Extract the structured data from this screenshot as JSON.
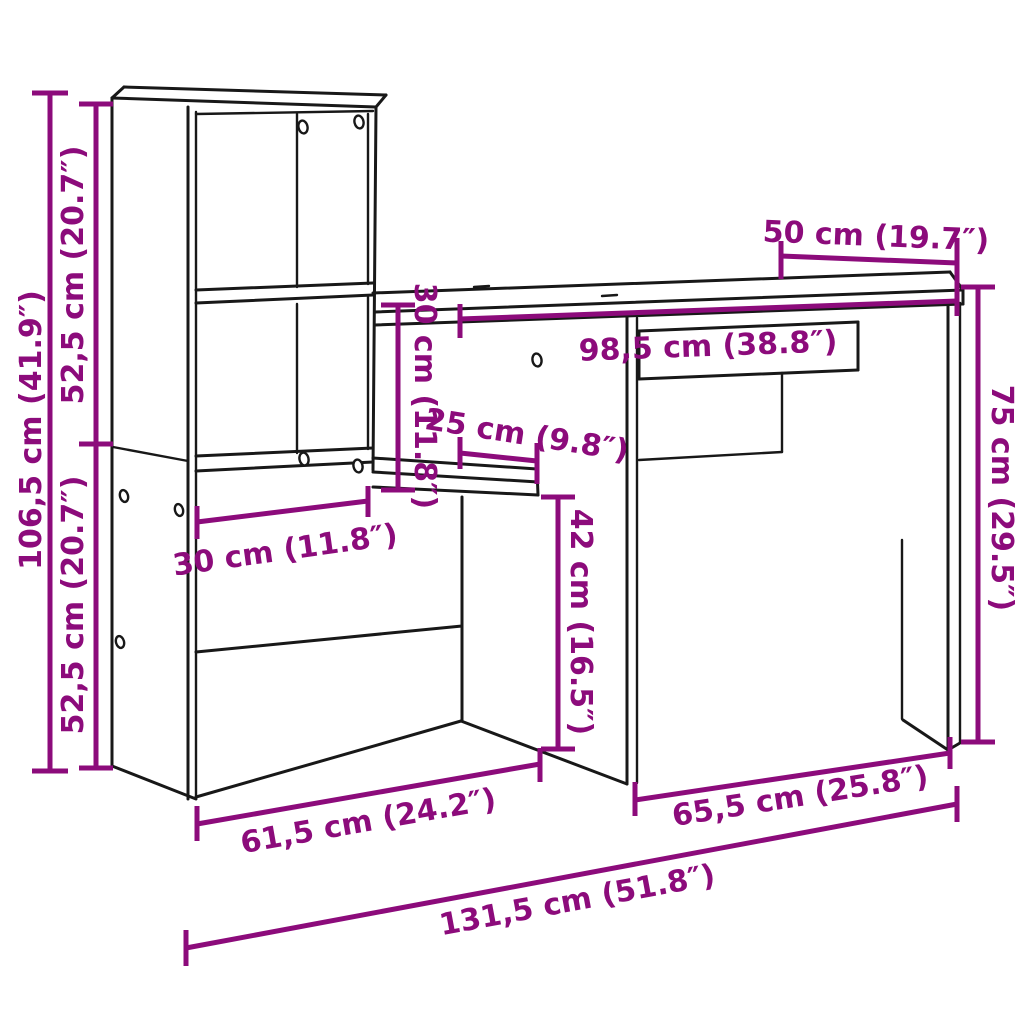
{
  "diagram": {
    "type": "furniture-dimension-diagram",
    "subject": "desk-with-shelving-unit",
    "colors": {
      "dimension": "#8C0B7B",
      "outline": "#181818",
      "background": "#ffffff"
    },
    "dims": {
      "total_height": "106,5 cm (41.9″)",
      "top_section_height": "52,5 cm (20.7″)",
      "bottom_section_height": "52,5 cm (20.7″)",
      "desk_depth": "50 cm (19.7″)",
      "desktop_width": "98,5 cm (38.8″)",
      "shelf_opening_height": "30 cm (11.8″)",
      "shelf_depth": "25 cm (9.8″)",
      "shelf_width": "30 cm (11.8″)",
      "underdesk_clearance": "42 cm (16.5″)",
      "desk_height": "75 cm (29.5″)",
      "left_floor_width": "61,5 cm (24.2″)",
      "right_floor_width": "65,5 cm (25.8″)",
      "total_width": "131,5 cm (51.8″)"
    }
  }
}
